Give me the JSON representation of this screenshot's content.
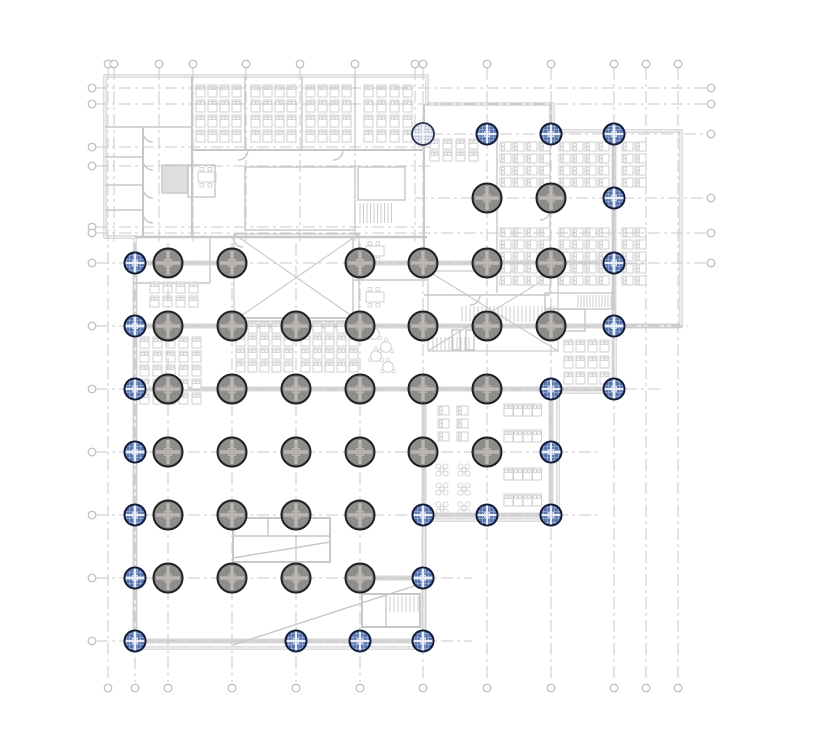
{
  "canvas": {
    "width": 828,
    "height": 751,
    "background": "#ffffff"
  },
  "colors": {
    "wall": "#c7c7c7",
    "wallLight": "#d2d2d2",
    "beam": "#d7d7d7",
    "core": "#dedede",
    "furniture": "#cfcfcf",
    "grid": "#c8cacd",
    "bubble": "#b9bbbe",
    "colGrayFill": "#8f8d8b",
    "colGrayEdge": "#1f1f1f",
    "colGrayCross": "#bab7b3",
    "colBlueFill": "#5673ae",
    "colBlueEdge": "#101a36",
    "colBlueCross": "#e9edf7",
    "colLightFill": "#e8ebf2",
    "colLightEdge": "#28324e",
    "colLightHatch": "#8d9cc0"
  },
  "grid": {
    "dash": "12 4 3 4",
    "bubble_r": 3.8,
    "top_bubble_y": 64,
    "bottom_bubble_y": 688,
    "left_bubble_x": 92,
    "right_bubble_x": 711,
    "vlines": [
      {
        "x": 108,
        "y1": 68,
        "y2": 682,
        "bt": true,
        "bb": true
      },
      {
        "x": 114,
        "y1": 68,
        "y2": 243,
        "bt": true
      },
      {
        "x": 159,
        "y1": 68,
        "y2": 243,
        "bt": true
      },
      {
        "x": 193,
        "y1": 68,
        "y2": 243,
        "bt": true
      },
      {
        "x": 246,
        "y1": 68,
        "y2": 243,
        "bt": true
      },
      {
        "x": 300,
        "y1": 68,
        "y2": 243,
        "bt": true
      },
      {
        "x": 355,
        "y1": 68,
        "y2": 243,
        "bt": true
      },
      {
        "x": 415,
        "y1": 68,
        "y2": 243,
        "bt": true
      },
      {
        "x": 135,
        "y1": 243,
        "y2": 682,
        "bb": true
      },
      {
        "x": 168,
        "y1": 243,
        "y2": 682,
        "bb": true
      },
      {
        "x": 232,
        "y1": 243,
        "y2": 682,
        "bb": true
      },
      {
        "x": 296,
        "y1": 243,
        "y2": 682,
        "bb": true
      },
      {
        "x": 360,
        "y1": 243,
        "y2": 682,
        "bb": true
      },
      {
        "x": 423,
        "y1": 68,
        "y2": 682,
        "bt": true,
        "bb": true
      },
      {
        "x": 487,
        "y1": 68,
        "y2": 682,
        "bt": true,
        "bb": true
      },
      {
        "x": 551,
        "y1": 68,
        "y2": 682,
        "bt": true,
        "bb": true
      },
      {
        "x": 614,
        "y1": 68,
        "y2": 682,
        "bt": true,
        "bb": true
      },
      {
        "x": 646,
        "y1": 68,
        "y2": 682,
        "bt": true,
        "bb": true
      },
      {
        "x": 678,
        "y1": 68,
        "y2": 682,
        "bt": true,
        "bb": true
      }
    ],
    "hlines": [
      {
        "y": 88,
        "x1": 96,
        "x2": 706,
        "bl": true,
        "br": true
      },
      {
        "y": 104,
        "x1": 96,
        "x2": 706,
        "bl": true,
        "br": true
      },
      {
        "y": 134,
        "x1": 408,
        "x2": 706,
        "br": true
      },
      {
        "y": 147,
        "x1": 96,
        "x2": 430,
        "bl": true
      },
      {
        "y": 166,
        "x1": 96,
        "x2": 430,
        "bl": true
      },
      {
        "y": 198,
        "x1": 415,
        "x2": 706,
        "br": true
      },
      {
        "y": 227,
        "x1": 96,
        "x2": 430,
        "bl": true
      },
      {
        "y": 233,
        "x1": 96,
        "x2": 706,
        "bl": true,
        "br": true
      },
      {
        "y": 263,
        "x1": 96,
        "x2": 706,
        "bl": true,
        "br": true
      },
      {
        "y": 326,
        "x1": 96,
        "x2": 688,
        "bl": true
      },
      {
        "y": 389,
        "x1": 96,
        "x2": 660,
        "bl": true
      },
      {
        "y": 452,
        "x1": 96,
        "x2": 600,
        "bl": true
      },
      {
        "y": 515,
        "x1": 96,
        "x2": 600,
        "bl": true
      },
      {
        "y": 578,
        "x1": 96,
        "x2": 472,
        "bl": true
      },
      {
        "y": 641,
        "x1": 96,
        "x2": 472,
        "bl": true
      }
    ]
  },
  "columns": {
    "gray_r": 14.5,
    "blue_r": 10.5,
    "light_r": 11,
    "items": [
      {
        "x": 423,
        "y": 134,
        "t": "l"
      },
      {
        "x": 487,
        "y": 134,
        "t": "b"
      },
      {
        "x": 551,
        "y": 134,
        "t": "b"
      },
      {
        "x": 614,
        "y": 134,
        "t": "b"
      },
      {
        "x": 487,
        "y": 198,
        "t": "g"
      },
      {
        "x": 551,
        "y": 198,
        "t": "g"
      },
      {
        "x": 614,
        "y": 198,
        "t": "b"
      },
      {
        "x": 135,
        "y": 263,
        "t": "b"
      },
      {
        "x": 168,
        "y": 263,
        "t": "g"
      },
      {
        "x": 232,
        "y": 263,
        "t": "g"
      },
      {
        "x": 360,
        "y": 263,
        "t": "g"
      },
      {
        "x": 423,
        "y": 263,
        "t": "g"
      },
      {
        "x": 487,
        "y": 263,
        "t": "g"
      },
      {
        "x": 551,
        "y": 263,
        "t": "g"
      },
      {
        "x": 614,
        "y": 263,
        "t": "b"
      },
      {
        "x": 135,
        "y": 326,
        "t": "b"
      },
      {
        "x": 168,
        "y": 326,
        "t": "g"
      },
      {
        "x": 232,
        "y": 326,
        "t": "g"
      },
      {
        "x": 296,
        "y": 326,
        "t": "g"
      },
      {
        "x": 360,
        "y": 326,
        "t": "g"
      },
      {
        "x": 423,
        "y": 326,
        "t": "g"
      },
      {
        "x": 487,
        "y": 326,
        "t": "g"
      },
      {
        "x": 551,
        "y": 326,
        "t": "g"
      },
      {
        "x": 614,
        "y": 326,
        "t": "b"
      },
      {
        "x": 135,
        "y": 389,
        "t": "b"
      },
      {
        "x": 168,
        "y": 389,
        "t": "g"
      },
      {
        "x": 232,
        "y": 389,
        "t": "g"
      },
      {
        "x": 296,
        "y": 389,
        "t": "g"
      },
      {
        "x": 360,
        "y": 389,
        "t": "g"
      },
      {
        "x": 423,
        "y": 389,
        "t": "g"
      },
      {
        "x": 487,
        "y": 389,
        "t": "g"
      },
      {
        "x": 551,
        "y": 389,
        "t": "b"
      },
      {
        "x": 614,
        "y": 389,
        "t": "b"
      },
      {
        "x": 135,
        "y": 452,
        "t": "b"
      },
      {
        "x": 168,
        "y": 452,
        "t": "g"
      },
      {
        "x": 232,
        "y": 452,
        "t": "g"
      },
      {
        "x": 296,
        "y": 452,
        "t": "g"
      },
      {
        "x": 360,
        "y": 452,
        "t": "g"
      },
      {
        "x": 423,
        "y": 452,
        "t": "g"
      },
      {
        "x": 487,
        "y": 452,
        "t": "g"
      },
      {
        "x": 551,
        "y": 452,
        "t": "b"
      },
      {
        "x": 135,
        "y": 515,
        "t": "b"
      },
      {
        "x": 168,
        "y": 515,
        "t": "g"
      },
      {
        "x": 232,
        "y": 515,
        "t": "g"
      },
      {
        "x": 296,
        "y": 515,
        "t": "g"
      },
      {
        "x": 360,
        "y": 515,
        "t": "g"
      },
      {
        "x": 423,
        "y": 515,
        "t": "b"
      },
      {
        "x": 487,
        "y": 515,
        "t": "b"
      },
      {
        "x": 551,
        "y": 515,
        "t": "b"
      },
      {
        "x": 135,
        "y": 578,
        "t": "b"
      },
      {
        "x": 168,
        "y": 578,
        "t": "g"
      },
      {
        "x": 232,
        "y": 578,
        "t": "g"
      },
      {
        "x": 296,
        "y": 578,
        "t": "g"
      },
      {
        "x": 360,
        "y": 578,
        "t": "g"
      },
      {
        "x": 423,
        "y": 578,
        "t": "b"
      },
      {
        "x": 135,
        "y": 641,
        "t": "b"
      },
      {
        "x": 296,
        "y": 641,
        "t": "b"
      },
      {
        "x": 360,
        "y": 641,
        "t": "b"
      },
      {
        "x": 423,
        "y": 641,
        "t": "b"
      }
    ]
  },
  "plan": {
    "outer": "M105,76 L427,76 L427,104 L553,104 L553,131 L681,131 L681,326 L615,326 L615,392 L558,392 L558,520 L424,520 L424,648 L135,648 L135,237 L105,237 Z",
    "beams": [
      [
        135,
        250,
        135,
        645
      ],
      [
        424,
        389,
        424,
        645
      ],
      [
        551,
        389,
        551,
        518
      ],
      [
        614,
        131,
        614,
        389
      ],
      [
        135,
        263,
        232,
        263
      ],
      [
        360,
        263,
        614,
        263
      ],
      [
        135,
        326,
        681,
        326
      ],
      [
        135,
        389,
        615,
        389
      ],
      [
        423,
        515,
        558,
        515
      ],
      [
        360,
        578,
        424,
        578
      ],
      [
        135,
        641,
        423,
        641
      ]
    ],
    "shapes": [
      {
        "t": "l",
        "p": [
          192,
          76,
          192,
          237
        ],
        "w": 2.2
      },
      {
        "t": "l",
        "p": [
          192,
          150,
          425,
          150
        ],
        "w": 2
      },
      {
        "t": "l",
        "p": [
          245,
          76,
          245,
          150
        ]
      },
      {
        "t": "l",
        "p": [
          302,
          76,
          302,
          150
        ]
      },
      {
        "t": "l",
        "p": [
          355,
          76,
          355,
          150
        ]
      },
      {
        "t": "l",
        "p": [
          105,
          127,
          192,
          127
        ]
      },
      {
        "t": "l",
        "p": [
          143,
          127,
          143,
          237
        ],
        "w": 2
      },
      {
        "t": "l",
        "p": [
          105,
          157,
          143,
          157
        ]
      },
      {
        "t": "l",
        "p": [
          105,
          185,
          143,
          185
        ]
      },
      {
        "t": "l",
        "p": [
          105,
          210,
          143,
          210
        ]
      },
      {
        "t": "l",
        "p": [
          135,
          237,
          427,
          237
        ],
        "w": 2.5
      },
      {
        "t": "l",
        "p": [
          424,
          104,
          424,
          263
        ],
        "w": 2
      },
      {
        "t": "r",
        "p": [
          162,
          165,
          26,
          28
        ],
        "f": true
      },
      {
        "t": "r",
        "p": [
          188,
          165,
          27,
          32
        ]
      },
      {
        "t": "r",
        "p": [
          358,
          167,
          47,
          33
        ]
      },
      {
        "t": "hb",
        "p": [
          360,
          203,
          33,
          20
        ],
        "s": 3.5
      },
      {
        "t": "r",
        "p": [
          245,
          167,
          110,
          63
        ]
      },
      {
        "t": "p",
        "d": "M248,150 a10,10 0 0 1 -10,10"
      },
      {
        "t": "p",
        "d": "M343,150 a10,10 0 0 1 -10,10"
      },
      {
        "t": "p",
        "d": "M143,132 a10,10 0 0 0 10,10"
      },
      {
        "t": "p",
        "d": "M143,160 a10,10 0 0 0 10,10"
      },
      {
        "t": "p",
        "d": "M143,188 a10,10 0 0 0 10,10"
      },
      {
        "t": "p",
        "d": "M143,213 a10,10 0 0 0 10,10"
      },
      {
        "t": "l",
        "p": [
          497,
          131,
          497,
          293
        ]
      },
      {
        "t": "l",
        "p": [
          550,
          104,
          550,
          293
        ]
      },
      {
        "t": "l",
        "p": [
          613,
          131,
          613,
          293
        ]
      },
      {
        "t": "l",
        "p": [
          424,
          295,
          550,
          295
        ]
      },
      {
        "t": "r",
        "p": [
          545,
          293,
          68,
          16
        ]
      },
      {
        "t": "hb",
        "p": [
          578,
          295,
          33,
          12
        ],
        "s": 3
      },
      {
        "t": "r",
        "p": [
          545,
          309,
          40,
          22
        ]
      },
      {
        "t": "l",
        "p": [
          135,
          283,
          210,
          283
        ]
      },
      {
        "t": "l",
        "p": [
          210,
          237,
          210,
          283
        ]
      },
      {
        "t": "l",
        "p": [
          233,
          318,
          360,
          318
        ],
        "w": 2
      },
      {
        "t": "l",
        "p": [
          353,
          237,
          353,
          318
        ]
      },
      {
        "t": "l",
        "p": [
          353,
          280,
          427,
          280
        ]
      },
      {
        "t": "r",
        "p": [
          234,
          234,
          125,
          87
        ],
        "w": 1.1
      },
      {
        "t": "p",
        "d": "M234,234 L359,321 M359,234 L234,321",
        "w": 1.1
      },
      {
        "t": "r",
        "p": [
          428,
          271,
          130,
          80
        ],
        "w": 1.1
      },
      {
        "t": "p",
        "d": "M428,271 L558,351 M558,271 L428,351",
        "w": 1.1
      },
      {
        "t": "hb",
        "p": [
          462,
          306,
          94,
          16
        ],
        "s": 4
      },
      {
        "t": "hb",
        "p": [
          433,
          337,
          38,
          14
        ],
        "s": 4
      },
      {
        "t": "r",
        "p": [
          452,
          330,
          8,
          20
        ]
      },
      {
        "t": "r",
        "p": [
          466,
          330,
          8,
          20
        ]
      },
      {
        "t": "r",
        "p": [
          233,
          518,
          97,
          44
        ],
        "w": 2
      },
      {
        "t": "l",
        "p": [
          233,
          536,
          330,
          536
        ]
      },
      {
        "t": "l",
        "p": [
          268,
          518,
          268,
          536
        ]
      },
      {
        "t": "l",
        "p": [
          296,
          536,
          296,
          562
        ]
      },
      {
        "t": "p",
        "d": "M233,558 L330,542"
      },
      {
        "t": "r",
        "p": [
          362,
          594,
          58,
          33
        ],
        "w": 2
      },
      {
        "t": "r",
        "p": [
          362,
          594,
          24,
          33
        ]
      },
      {
        "t": "hb",
        "p": [
          390,
          596,
          28,
          16
        ],
        "s": 4
      },
      {
        "t": "p",
        "d": "M233,645 L420,584"
      },
      {
        "t": "p",
        "d": "M480,295 a10,10 0 0 1 -10,10"
      },
      {
        "t": "p",
        "d": "M550,210 a10,10 0 0 1 -10,10"
      },
      {
        "t": "p",
        "d": "M233,237 a10,10 0 0 0 10,10"
      }
    ],
    "desk_clusters": [
      {
        "x": 196,
        "y": 85,
        "cols": 4,
        "rows": 4,
        "dx": 12,
        "dy": 15,
        "w": 9,
        "h": 12,
        "o": "h"
      },
      {
        "x": 251,
        "y": 85,
        "cols": 4,
        "rows": 4,
        "dx": 12,
        "dy": 15,
        "w": 9,
        "h": 12,
        "o": "h"
      },
      {
        "x": 306,
        "y": 85,
        "cols": 4,
        "rows": 4,
        "dx": 12,
        "dy": 15,
        "w": 9,
        "h": 12,
        "o": "h"
      },
      {
        "x": 364,
        "y": 85,
        "cols": 4,
        "rows": 4,
        "dx": 13,
        "dy": 15,
        "w": 9,
        "h": 12,
        "o": "h"
      },
      {
        "x": 500,
        "y": 142,
        "cols": 4,
        "rows": 4,
        "dx": 13,
        "dy": 12,
        "w": 11,
        "h": 9,
        "o": "v"
      },
      {
        "x": 500,
        "y": 228,
        "cols": 4,
        "rows": 5,
        "dx": 13,
        "dy": 12,
        "w": 11,
        "h": 9,
        "o": "v"
      },
      {
        "x": 559,
        "y": 142,
        "cols": 4,
        "rows": 4,
        "dx": 13,
        "dy": 12,
        "w": 11,
        "h": 9,
        "o": "v"
      },
      {
        "x": 559,
        "y": 228,
        "cols": 4,
        "rows": 5,
        "dx": 13,
        "dy": 12,
        "w": 11,
        "h": 9,
        "o": "v"
      },
      {
        "x": 622,
        "y": 142,
        "cols": 2,
        "rows": 4,
        "dx": 13,
        "dy": 12,
        "w": 11,
        "h": 9,
        "o": "v"
      },
      {
        "x": 622,
        "y": 228,
        "cols": 2,
        "rows": 5,
        "dx": 13,
        "dy": 12,
        "w": 11,
        "h": 9,
        "o": "v"
      },
      {
        "x": 430,
        "y": 139,
        "cols": 4,
        "rows": 2,
        "dx": 13,
        "dy": 12,
        "w": 9,
        "h": 10,
        "o": "h"
      },
      {
        "x": 150,
        "y": 282,
        "cols": 4,
        "rows": 2,
        "dx": 13,
        "dy": 14,
        "w": 9,
        "h": 11,
        "o": "h"
      },
      {
        "x": 140,
        "y": 337,
        "cols": 5,
        "rows": 5,
        "dx": 13,
        "dy": 14,
        "w": 9,
        "h": 11,
        "o": "h"
      },
      {
        "x": 236,
        "y": 322,
        "cols": 5,
        "rows": 4,
        "dx": 12,
        "dy": 13,
        "w": 9,
        "h": 11,
        "o": "h"
      },
      {
        "x": 301,
        "y": 322,
        "cols": 5,
        "rows": 4,
        "dx": 12,
        "dy": 13,
        "w": 9,
        "h": 11,
        "o": "h"
      },
      {
        "x": 564,
        "y": 340,
        "cols": 4,
        "rows": 3,
        "dx": 12,
        "dy": 16,
        "w": 9,
        "h": 12,
        "o": "h"
      },
      {
        "x": 438,
        "y": 406,
        "cols": 2,
        "rows": 3,
        "dx": 19,
        "dy": 13,
        "w": 11,
        "h": 9,
        "o": "v"
      },
      {
        "x": 504,
        "y": 404,
        "cols": 4,
        "rows": 2,
        "dx": 9.5,
        "dy": 26,
        "w": 9,
        "h": 12,
        "o": "h"
      },
      {
        "x": 504,
        "y": 468,
        "cols": 4,
        "rows": 2,
        "dx": 9.5,
        "dy": 26,
        "w": 9,
        "h": 12,
        "o": "h"
      }
    ],
    "x_tables": [
      {
        "x": 442,
        "y": 470
      },
      {
        "x": 464,
        "y": 470
      },
      {
        "x": 442,
        "y": 489
      },
      {
        "x": 464,
        "y": 489
      },
      {
        "x": 442,
        "y": 508
      },
      {
        "x": 464,
        "y": 508
      }
    ],
    "round_tables": [
      {
        "x": 374,
        "y": 334
      },
      {
        "x": 386,
        "y": 347
      },
      {
        "x": 376,
        "y": 356
      },
      {
        "x": 388,
        "y": 367
      }
    ],
    "meeting_tables": [
      {
        "x": 366,
        "y": 246
      },
      {
        "x": 366,
        "y": 292
      },
      {
        "x": 198,
        "y": 172
      }
    ]
  }
}
